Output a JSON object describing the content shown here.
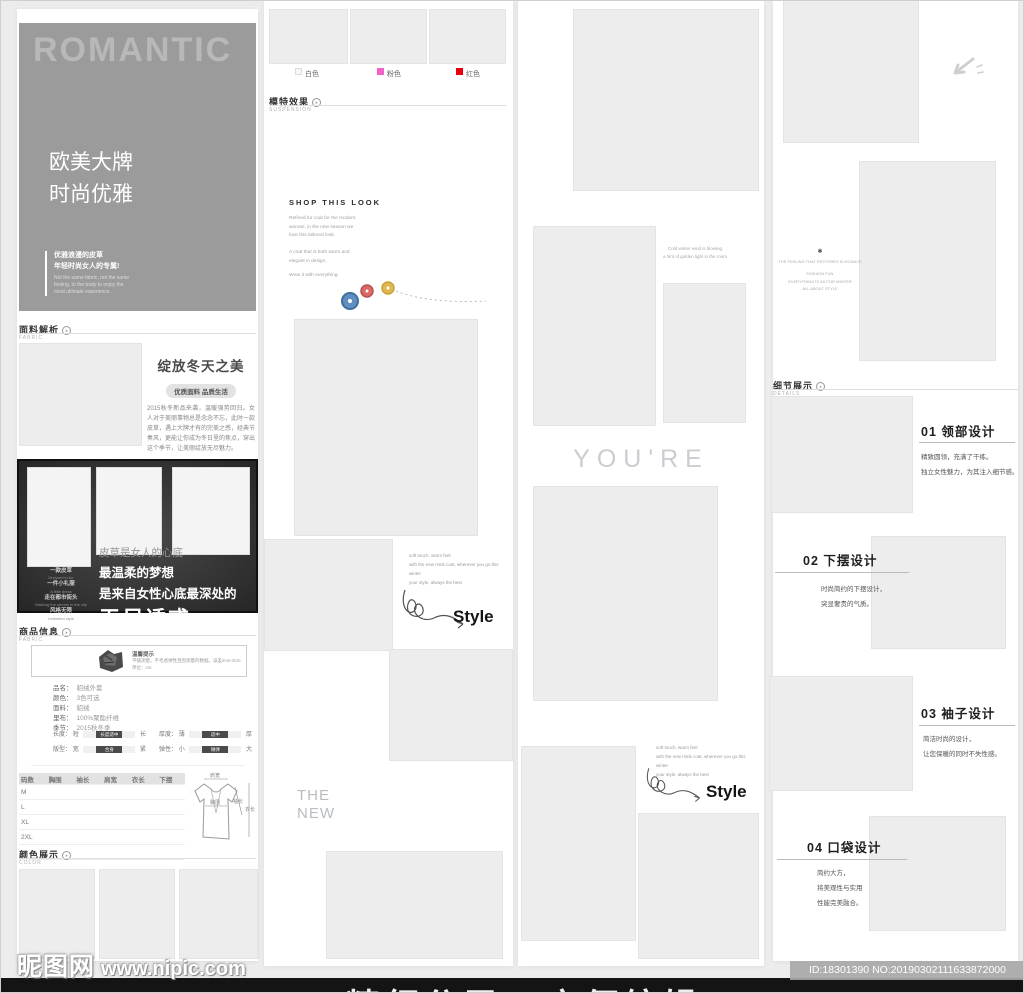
{
  "col1": {
    "hero": {
      "title": "ROMANTIC",
      "line1": "欧美大牌",
      "line2": "时尚优雅",
      "note_cn1": "优雅浪漫的皮草",
      "note_cn2": "年轻时尚女人的专属!",
      "note_en1": "Not the same fabric, not the same",
      "note_en2": "feeling, to the body to enjoy the",
      "note_en3": "most ultimate experience."
    },
    "fabric_header": {
      "title": "面料解析",
      "sub": "FABRIC"
    },
    "fabric_card": {
      "headline": "绽放冬天之美",
      "badge": "优质面料 品质生活",
      "body": "2015秋冬新品来袭，温暖强势回归。女人对于美丽事物总是念念不忘，此时一款皮草，遇上大牌才有的完美之感，经典节奏风，更能让你成为冬日里的焦点，穿出这个季节，让美丽绽放无尽魅力。"
    },
    "banner": {
      "side": [
        "一款皮草",
        "Dressed in fur",
        "一件小礼服",
        "A little dress",
        "走在都市街头",
        "Walking the streets in the city",
        "风格无限",
        "Unlimited style"
      ],
      "line1": "皮草是女人的心底",
      "line2": "最温柔的梦想",
      "line3": "是来自女性心底最深处的",
      "line4": "无尽诱惑"
    },
    "product_header": {
      "title": "商品信息",
      "sub": "FABRIC"
    },
    "tip": {
      "title": "温馨提示",
      "line1": "平铺测量，不考虑弹性且因测量的数据，误差2cm-3cm",
      "line2": "单位：cm"
    },
    "attrs": [
      {
        "label": "品名：",
        "value": "貂绒外套"
      },
      {
        "label": "颜色：",
        "value": "3色可选"
      },
      {
        "label": "面料：",
        "value": "貂绒"
      },
      {
        "label": "里布：",
        "value": "100%聚酯纤维"
      },
      {
        "label": "季节：",
        "value": "2015秋冬季"
      }
    ],
    "sliders": [
      {
        "label": "长度：",
        "min": "短",
        "chip": "长度适中",
        "max": "长"
      },
      {
        "label": "厚度：",
        "min": "薄",
        "chip": "适中",
        "max": "厚"
      },
      {
        "label": "版型：",
        "min": "宽",
        "chip": "合身",
        "max": "紧"
      },
      {
        "label": "弹性：",
        "min": "小",
        "chip": "微弹",
        "max": "大"
      }
    ],
    "size_table": {
      "headers": [
        "码数",
        "胸围",
        "袖长",
        "肩宽",
        "衣长",
        "下摆"
      ],
      "rows": [
        "M",
        "L",
        "XL",
        "2XL"
      ]
    },
    "diagram": {
      "labels": [
        "肩宽",
        "胸围",
        "袖长",
        "衣长"
      ]
    },
    "color_header": {
      "title": "颜色展示",
      "sub": "COLOR"
    }
  },
  "col2": {
    "swatches": [
      {
        "label": "白色",
        "color": "#f7f7f7"
      },
      {
        "label": "粉色",
        "color": "#f360c8"
      },
      {
        "label": "红色",
        "color": "#e60012"
      }
    ],
    "model_header": {
      "title": "模特效果",
      "sub": "SUSPENSION"
    },
    "shop": {
      "title": "SHOP THIS LOOK",
      "p1": "Refined fur coat for the modern",
      "p2": "woman, in the new season we",
      "p3": "love this tailored look.",
      "p4": "A coat that is both warm and",
      "p5": "elegant in design.",
      "p6": "Wear it with everything."
    },
    "style1": {
      "n1": "soft touch, warm feel",
      "n2": "with the new mink coat, wherever you go this winter",
      "n3": "your style, always the best",
      "label": "Style"
    },
    "the_new1": "THE",
    "the_new2": "NEW"
  },
  "col3": {
    "caption1": "Cold winter wind is blowing",
    "caption2": "a hint of golden light in the room",
    "youre": "YOU'RE",
    "style2": {
      "n1": "soft touch, warm feel",
      "n2": "with the new mink coat, wherever you go this winter",
      "n3": "your style, always the best",
      "label": "Style"
    }
  },
  "col4": {
    "mini": {
      "icon": "✱",
      "l1": "THE FEELING THAT RESTORES ELEGANCE",
      "l2": "FASHION FUN",
      "l3": "EVERYTHING IS AS FOR WINTER",
      "l4": "ALL ABOUT STYLE"
    },
    "details_header": {
      "title": "细节展示",
      "sub": "DETAILS"
    },
    "items": [
      {
        "title": "01 领部设计",
        "l1": "精致圆领，充满了干练。",
        "l2": "独立女性魅力，为其注入细节感。",
        "l3": ""
      },
      {
        "title": "02 下摆设计",
        "l1": "时尚简约的下摆设计，",
        "l2": "突显奢贵的气质。",
        "l3": ""
      },
      {
        "title": "03 袖子设计",
        "l1": "简洁时尚的设计，",
        "l2": "让您保暖的同时不失性感。",
        "l3": ""
      },
      {
        "title": "04 口袋设计",
        "l1": "简约大方，",
        "l2": "将美观性与实用",
        "l3": "性能完美融合。"
      }
    ]
  },
  "footer": {
    "site": "昵图网",
    "url": "www.nipic.com",
    "id_text": "ID:18301390 NO:20190302111633872000",
    "bar_text": "精细分层 / 方便编辑"
  }
}
